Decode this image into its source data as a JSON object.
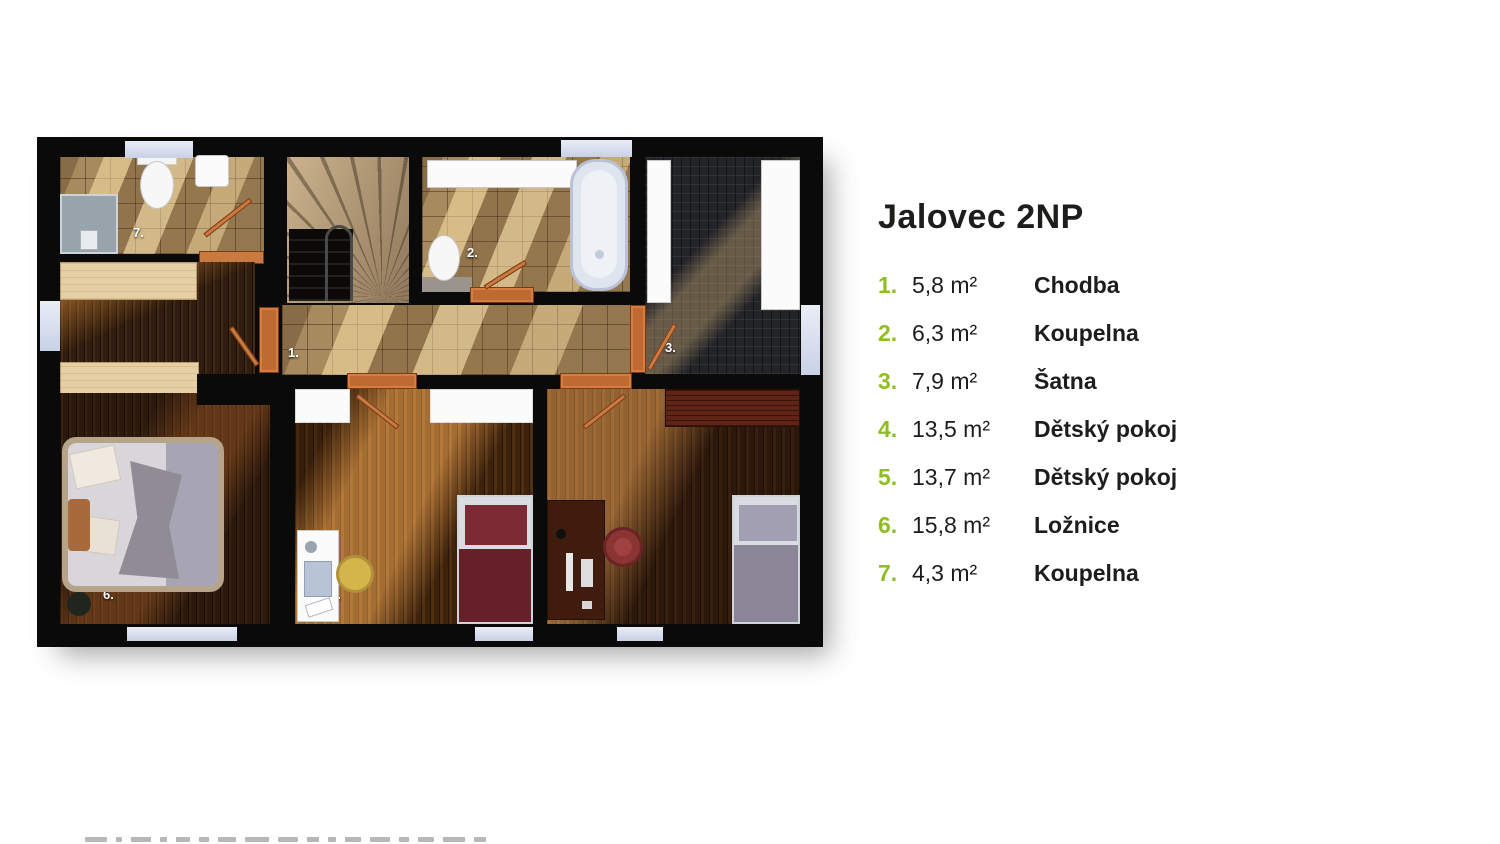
{
  "title": "Jalovec 2NP",
  "accent_color": "#8fbe21",
  "legend": {
    "items": [
      {
        "num": "1.",
        "area": "5,8 m²",
        "name": "Chodba"
      },
      {
        "num": "2.",
        "area": "6,3 m²",
        "name": "Koupelna"
      },
      {
        "num": "3.",
        "area": "7,9 m²",
        "name": "Šatna"
      },
      {
        "num": "4.",
        "area": "13,5 m²",
        "name": "Dětský pokoj"
      },
      {
        "num": "5.",
        "area": "13,7 m²",
        "name": "Dětský pokoj"
      },
      {
        "num": "6.",
        "area": "15,8 m²",
        "name": "Ložnice"
      },
      {
        "num": "7.",
        "area": "4,3 m²",
        "name": "Koupelna"
      }
    ]
  },
  "plan": {
    "labels": {
      "hallway": "1.",
      "bathroom2": "2.",
      "wardrobe3": "3.",
      "kidsroom4": "4.",
      "kidsroom5": "5.",
      "bedroom6": "6.",
      "bathroom7": "7."
    }
  }
}
